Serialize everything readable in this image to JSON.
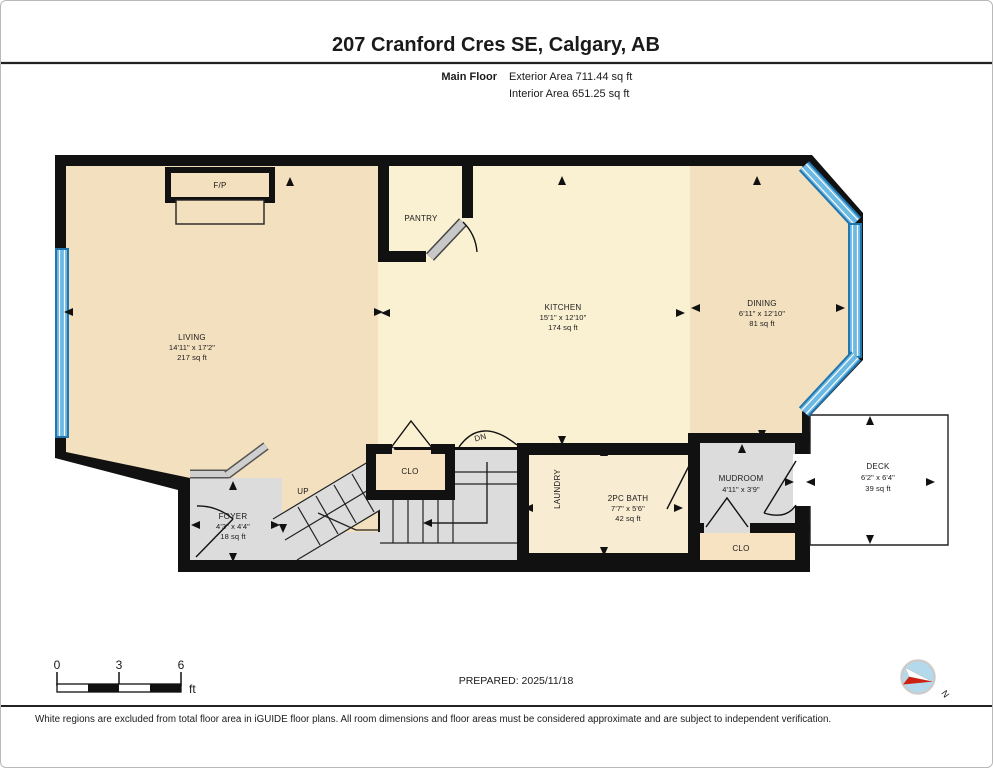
{
  "header": {
    "title": "207 Cranford Cres SE, Calgary, AB",
    "floor_label": "Main Floor",
    "exterior_area": "Exterior Area 711.44 sq ft",
    "interior_area": "Interior Area 651.25 sq ft"
  },
  "rooms": {
    "living": {
      "name": "LIVING",
      "dims": "14'11\" x 17'2\"",
      "area": "217 sq ft"
    },
    "kitchen": {
      "name": "KITCHEN",
      "dims": "15'1\" x 12'10\"",
      "area": "174 sq ft"
    },
    "dining": {
      "name": "DINING",
      "dims": "6'11\" x 12'10\"",
      "area": "81 sq ft"
    },
    "pantry": {
      "name": "PANTRY"
    },
    "fireplace": {
      "name": "F/P"
    },
    "foyer": {
      "name": "FOYER",
      "dims": "4'3\" x 4'4\"",
      "area": "18 sq ft"
    },
    "closet_hall": {
      "name": "CLO"
    },
    "closet_mud": {
      "name": "CLO"
    },
    "laundry": {
      "name": "LAUNDRY"
    },
    "bath": {
      "name": "2PC BATH",
      "dims": "7'7\" x 5'6\"",
      "area": "42 sq ft"
    },
    "mudroom": {
      "name": "MUDROOM",
      "dims": "4'11\" x 3'9\""
    },
    "deck": {
      "name": "DECK",
      "dims": "6'2\" x 6'4\"",
      "area": "39 sq ft"
    },
    "stairs_up": {
      "label": "UP"
    },
    "stairs_down": {
      "label": "DN"
    }
  },
  "scale_bar": {
    "ticks": [
      "0",
      "3",
      "6"
    ],
    "unit": "ft"
  },
  "compass": {
    "north_label": "N"
  },
  "footer": {
    "prepared": "PREPARED: 2025/11/18",
    "disclaimer": "White regions are excluded from total floor area in iGUIDE floor plans. All room dimensions and floor areas must be considered approximate and are subject to independent verification."
  },
  "colors": {
    "wall": "#111111",
    "room_tan": "#f3e0bf",
    "room_cream": "#faf0d2",
    "room_bath": "#f8ecd2",
    "room_closet": "#f7e3c2",
    "floor_gray": "#dcdcdc",
    "window_blue": "#6cb9e4",
    "window_blue_dark": "#2176ae",
    "compass_blue": "#b3d9ec",
    "compass_red": "#cc2212"
  }
}
